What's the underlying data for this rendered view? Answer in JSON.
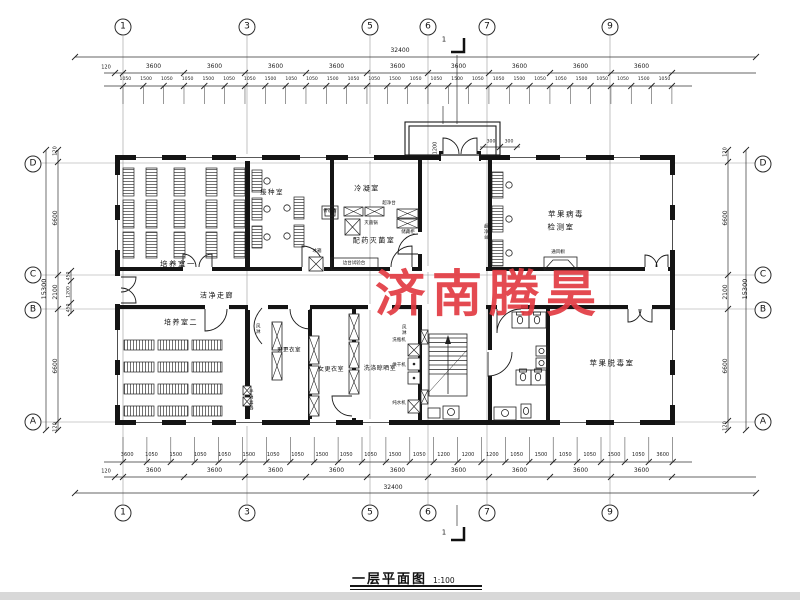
{
  "watermark": "济南腾昊",
  "title": {
    "name": "一层平面图",
    "scale": "1:100"
  },
  "section": {
    "label": "1"
  },
  "grid": {
    "top": [
      "1",
      "3",
      "5",
      "6",
      "7",
      "9"
    ],
    "bottom": [
      "1",
      "3",
      "5",
      "6",
      "7",
      "9"
    ],
    "left": [
      "D",
      "C",
      "B",
      "A"
    ],
    "right": [
      "D",
      "C",
      "B",
      "A"
    ]
  },
  "dims": {
    "top_overall": "32400",
    "top_edge": "120",
    "top_bays": [
      "3600",
      "3600",
      "3600",
      "3600",
      "3600",
      "3600",
      "3600",
      "3600",
      "3600"
    ],
    "top_detail": [
      "1050",
      "1500",
      "1050",
      "1050",
      "1500",
      "1050",
      "1050",
      "1500",
      "1050",
      "1050",
      "1500",
      "1050",
      "1050",
      "1500",
      "1050",
      "1050",
      "1500",
      "1050",
      "1050",
      "1500",
      "1050",
      "1050",
      "1500",
      "1050",
      "1050",
      "1500",
      "1050"
    ],
    "bottom_overall": "32400",
    "bottom_edge": "120",
    "bottom_bays": [
      "3600",
      "3600",
      "3600",
      "3600",
      "3600",
      "3600",
      "3600",
      "3600",
      "3600"
    ],
    "bottom_detail": [
      "3600",
      "1050",
      "1500",
      "1050",
      "1050",
      "1500",
      "1050",
      "1050",
      "1500",
      "1050",
      "1050",
      "1500",
      "1050",
      "1200",
      "1200",
      "1200",
      "1050",
      "1500",
      "1050",
      "1050",
      "1500",
      "1050",
      "3600"
    ],
    "left": {
      "overall": "15300",
      "e1": "120",
      "d1": "6600",
      "d2": "2100",
      "d3": "6600",
      "e2": "120",
      "sub": [
        "450",
        "1200",
        "450"
      ]
    },
    "right": {
      "overall": "15300",
      "e1": "120",
      "d1": "6600",
      "d2": "2100",
      "d3": "6600",
      "e2": "120"
    },
    "entrance": {
      "w": "1200",
      "a": "300",
      "b": "300"
    }
  },
  "rooms": {
    "culture1": "培养室一",
    "inoculation": "接种室",
    "condensation": "冷凝室",
    "prep": "配药灭菌室",
    "virus_test_1": "苹果病毒",
    "virus_test_2": "检测室",
    "corridor": "洁净走廊",
    "culture2": "培养室二",
    "men_change": "男更衣室",
    "women_change": "女更衣室",
    "washing": "洗涤晾晒室",
    "detox": "苹果脱毒室"
  },
  "equipment": {
    "pass_window": "传递窗",
    "fridge": "冰箱",
    "sterilizer": "灭菌锅",
    "cabinet": "储藏柜",
    "clean_bench": "超净台",
    "clean_bench2": "超净台",
    "side_bench": "边台试验台",
    "fume_hood": "通风橱",
    "air_shower1": "风淋",
    "air_shower2": "风淋",
    "hand_sanitizer": "手消毒器",
    "bottle_washer": "洗瓶机",
    "dryer": "烘干机",
    "water_purifier": "纯水机"
  }
}
